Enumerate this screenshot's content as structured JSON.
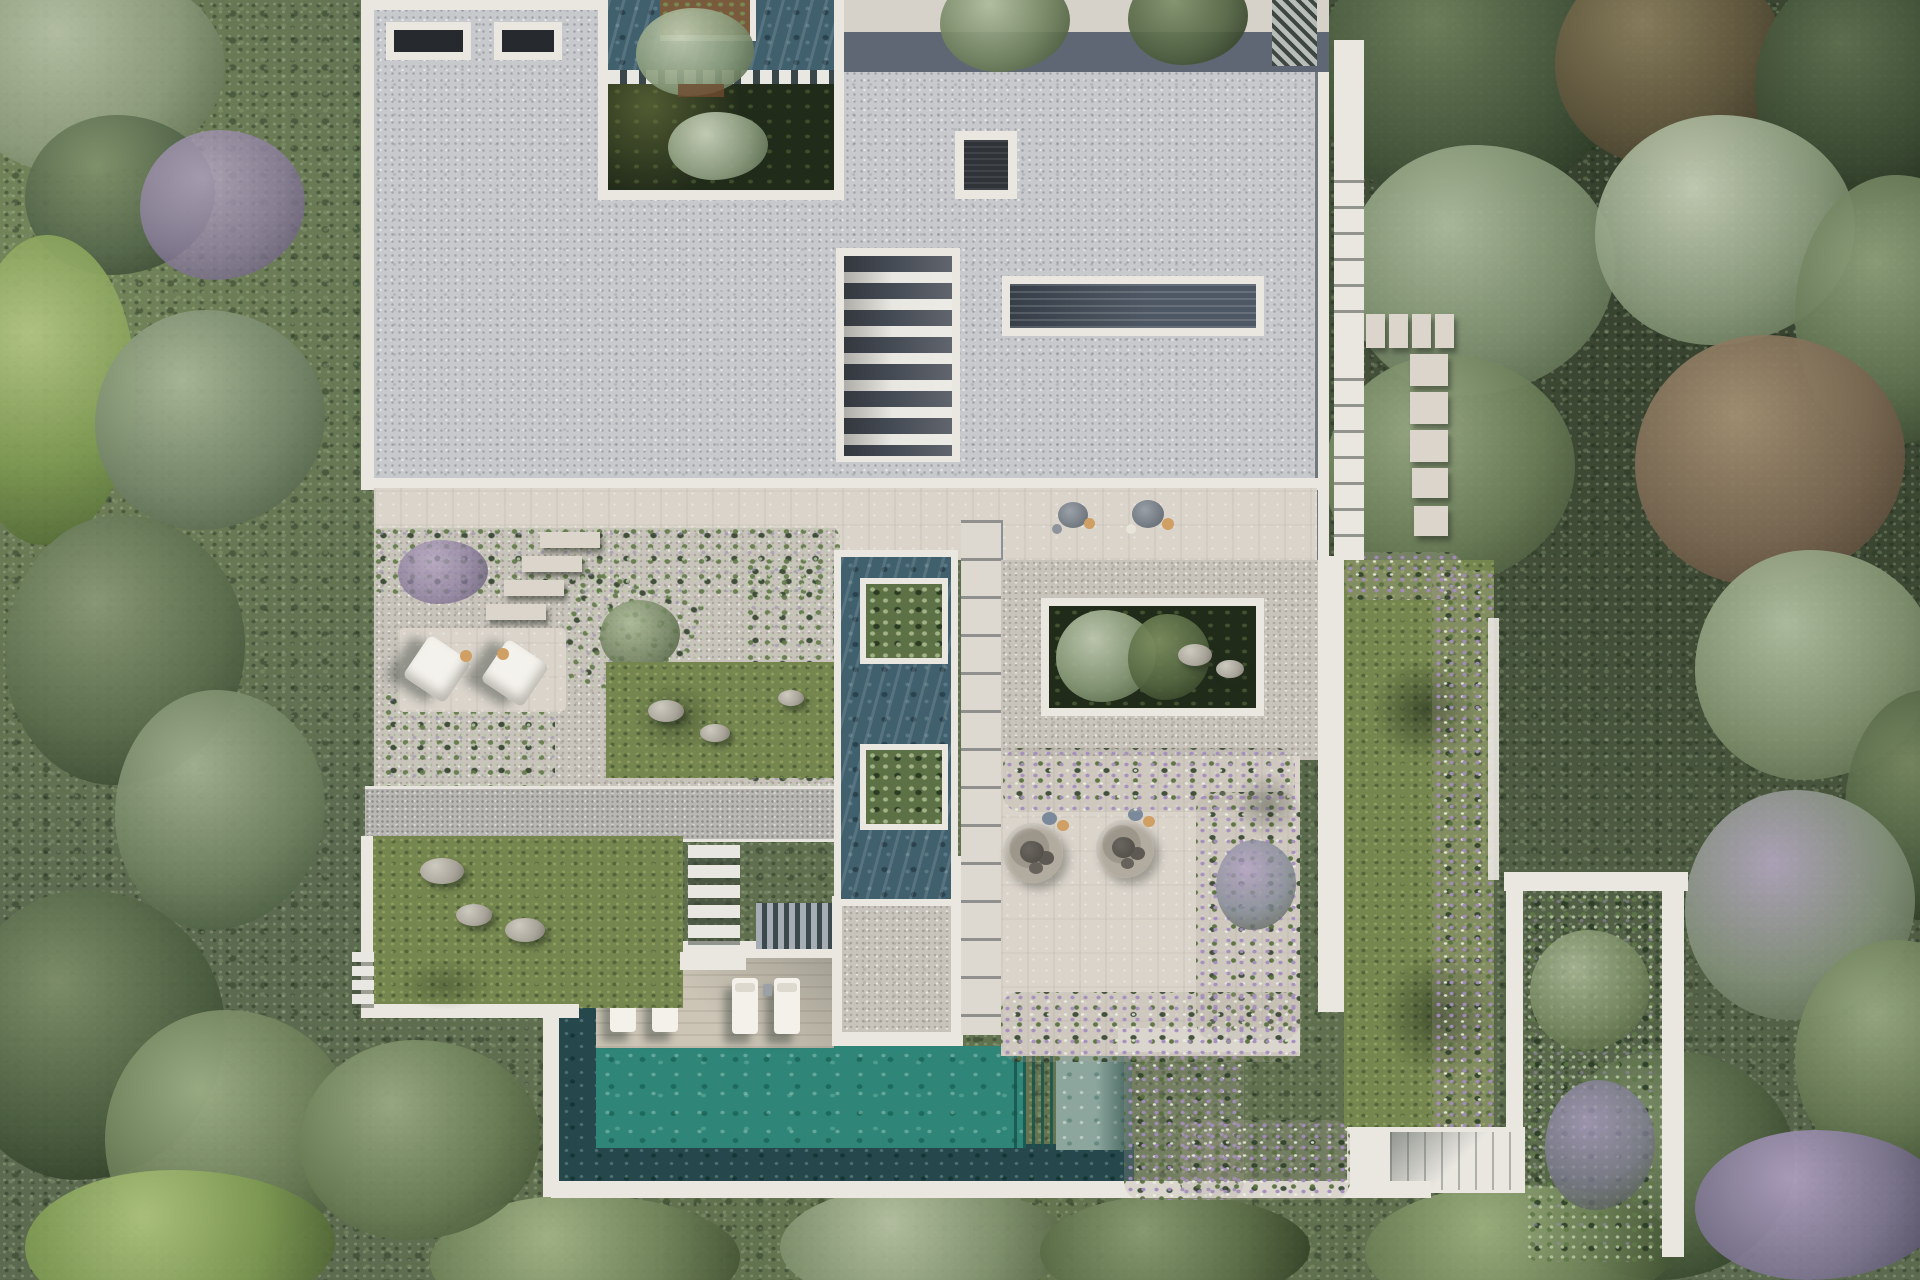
{
  "scene": {
    "label": "Aerial top-down rendering of a modern flat-roof villa estate",
    "surroundings_label": "Dense Mediterranean shrubland and trees surrounding the plot",
    "time_of_day_hint": "daylight with shadows cast toward lower-left"
  },
  "palette": {
    "roof": "#c7c9cc",
    "parapet_white": "#eae7e1",
    "walkway": "#dad4cb",
    "gravel": "#c8c4bc",
    "deck_wood": "#ccc5b6",
    "lawn": "#75864f",
    "pool_water": "#2f8577",
    "pool_pale": "#8ca69d",
    "pool_shadow": "#26484c",
    "reflecting_pool": "#41606e",
    "skylight_glass": "#26292e",
    "louver_gray": "#4e5864",
    "shadow_band": "#5e6773",
    "sunken_courtyard": "#212b19",
    "vegetation": "#5c6b4f",
    "flower_purple": "#a18fb5",
    "cushion_orange": "#cf9f63",
    "cushion_blue": "#7a8a9b",
    "planter_rust": "#7a5a3c",
    "stone_gray": "#a8a49a"
  },
  "counts": {
    "sun_loungers": 4,
    "shaded_daybeds": 2,
    "fire_pit_lounges": 2,
    "walkway_dining_sets": 2,
    "reflecting_pool_planters": 2,
    "small_roof_skylights": 2,
    "stair_skylight_louvers": 8,
    "courtyard_cutouts": 3,
    "stepping_stones_east": 9
  },
  "regions": {
    "forest": {
      "label": "Surrounding forest and shrubland"
    },
    "roof": {
      "label": "Main villa flat roof with gravel finish"
    },
    "roof_courtyard": {
      "label": "North courtyard cutout with trees, water and rust planter"
    },
    "skylight_small_a": {
      "label": "Small roof skylight"
    },
    "skylight_small_b": {
      "label": "Small roof skylight"
    },
    "skylight_square": {
      "label": "Square roof skylight"
    },
    "stair_skylight": {
      "label": "Louvered stair skylight"
    },
    "louver_skylight": {
      "label": "Long slatted skylight"
    },
    "north_terrace": {
      "label": "North edge terrace with shadow band"
    },
    "walkway": {
      "label": "Central paved walkway with two dining sets"
    },
    "west_garden": {
      "label": "West garden terrace with gravel and flowering shrubs"
    },
    "daybed_patio": {
      "label": "Patio with two shaded daybeds"
    },
    "rock_garden": {
      "label": "Rock garden lawn patch"
    },
    "west_lawn": {
      "label": "West lawn with boulders"
    },
    "reflecting_pool": {
      "label": "Reflecting pool with two tree planters"
    },
    "sunken_courtyard": {
      "label": "Sunken courtyard garden with trees and rocks"
    },
    "firepit_terrace": {
      "label": "Terrace with two circular fire-pit lounges"
    },
    "pool": {
      "label": "Swimming pool"
    },
    "pool_deck": {
      "label": "Timber pool deck with four sun loungers"
    },
    "east_lawn": {
      "label": "East lawn bordered by purple flowering shrubs"
    },
    "east_bed": {
      "label": "Framed flower bed on east side"
    },
    "stepping_stones": {
      "label": "Stepping-stone path on east side"
    },
    "south_stairs": {
      "label": "South garden stairs"
    },
    "paths": {
      "label": "White garden paths"
    }
  }
}
